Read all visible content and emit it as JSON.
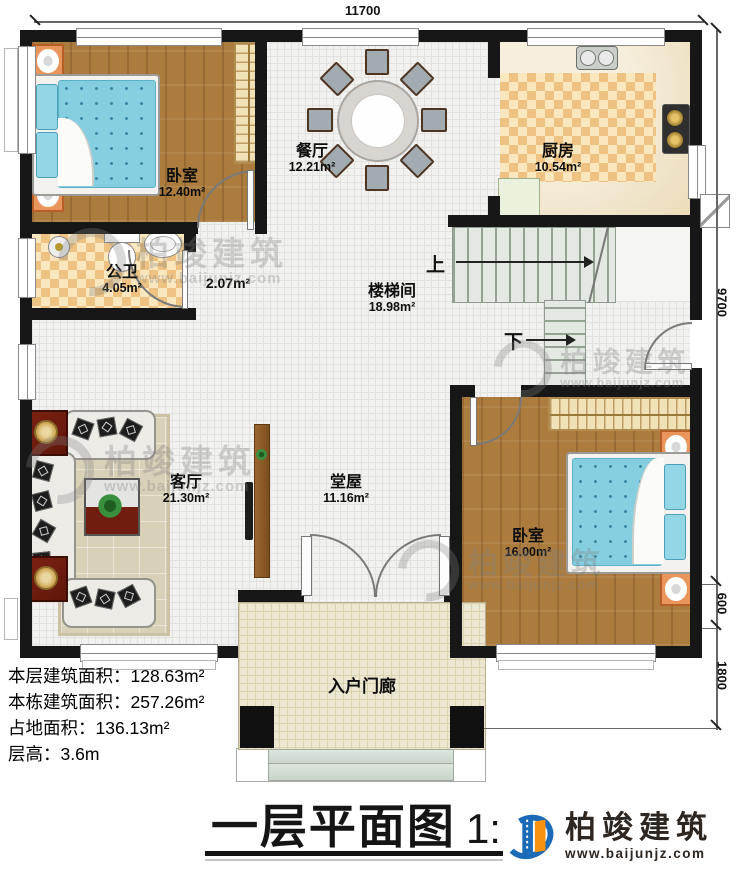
{
  "dimensions": {
    "top_width": "11700",
    "right_height": "9700",
    "right_step": "600",
    "right_porch": "1800"
  },
  "rooms": {
    "bedroom1": {
      "name": "卧室",
      "area": "12.40m²"
    },
    "dining": {
      "name": "餐厅",
      "area": "12.21m²"
    },
    "kitchen": {
      "name": "厨房",
      "area": "10.54m²"
    },
    "bathroom": {
      "name": "公卫",
      "area": "4.05m²"
    },
    "corridor": {
      "area": "2.07m²"
    },
    "stairwell": {
      "name": "楼梯间",
      "area": "18.98m²"
    },
    "living": {
      "name": "客厅",
      "area": "21.30m²"
    },
    "hall": {
      "name": "堂屋",
      "area": "11.16m²"
    },
    "bedroom2": {
      "name": "卧室",
      "area": "16.00m²"
    },
    "porch": {
      "name": "入户门廊"
    }
  },
  "stairs": {
    "up": "上",
    "down": "下"
  },
  "info": {
    "line1_label": "本层建筑面积：",
    "line1_value": "128.63m²",
    "line2_label": "本栋建筑面积：",
    "line2_value": "257.26m²",
    "line3_label": "占地面积：",
    "line3_value": "136.13m²",
    "line4_label": "层高：",
    "line4_value": "3.6m"
  },
  "title": {
    "text": "一层平面图",
    "scale": "1:100"
  },
  "brand": {
    "name": "柏竣建筑",
    "url": "www.baijunjz.com"
  },
  "watermark": {
    "name": "柏竣建筑",
    "url": "www.baijunjz.com"
  },
  "colors": {
    "wall": "#171717",
    "accent_blue": "#1b6ab8",
    "accent_orange": "#f6920e",
    "bed_blue": "#85cee0",
    "wood": "#ab7c3e",
    "checker": "#eec282"
  }
}
